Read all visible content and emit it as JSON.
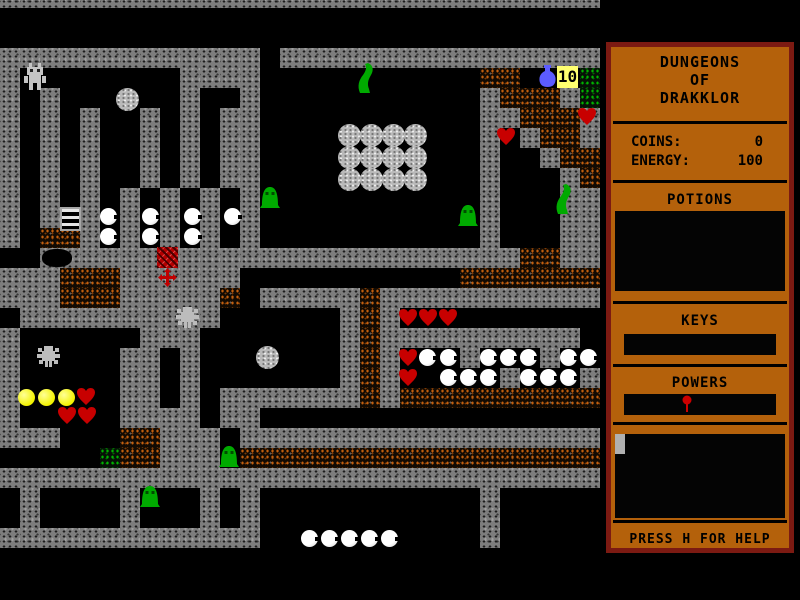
{
  "window": {
    "width": 800,
    "height": 600,
    "background": "#000000"
  },
  "colors": {
    "panel_bg": "#b4610b",
    "panel_border": "#7c1a12",
    "panel_text": "#000000",
    "wall_gray": "#7d7d7d",
    "dirt_orange": "#c3600f",
    "moss_green": "#00b400",
    "heart_red": "#c80000",
    "slime_green": "#00aa00",
    "pearl_white": "#ffffff",
    "flask_blue": "#5c5cff",
    "key_label_bg": "#ffff70",
    "power_dot_red": "#cc0000"
  },
  "sidebar": {
    "title_lines": [
      "DUNGEONS",
      "OF",
      "DRAKKLOR"
    ],
    "stats": [
      {
        "label": "COINS:",
        "value": "0"
      },
      {
        "label": "ENERGY:",
        "value": "100"
      }
    ],
    "potions_label": "POTIONS",
    "keys_label": "KEYS",
    "powers_label": "POWERS",
    "powers_items": [
      "balloon-icon"
    ],
    "inventory_items": [
      "gray-chip"
    ],
    "help_text": "PRESS H FOR HELP"
  },
  "hud": {
    "key_count": "10"
  },
  "map": {
    "tile_size": 20,
    "offset_y": -12,
    "legend": {
      "#": "wall",
      "%": "dirt",
      "g": "moss",
      ".": "floor"
    },
    "rows": [
      "##############################",
      "..............................",
      "..............................",
      "#############.################",
      "#........####...........%%...g",
      "#.#......#..#...........#%%%#g",
      "#.#.#..#.#.##...........##%%%#",
      "#.#.#..#.#.##...........#.#%%#",
      "#.#.#..#.#.##...........#..#%%",
      "#.#.#..#.#.##...........#...#%",
      "#.#.#.#.#.#.#...........#...##",
      "#.#.#.#.#.#.#...........#...##",
      "#.%%#.#.#.#.#...........#...##",
      "..########################%%##",
      "###%%%######...........%%%%%%%",
      "###%%%#####%.#####%###########",
      ".##########......#%#..........",
      "#......###.......#%##########",
      "#.....##.#.......#%#...#...#..",
      "#.....##.#.......#%#.....#...#",
      "#.....##.#.#######%#%%%%%%%%%%",
      "#.....####.##.................",
      "###...%%###.##################",
      ".....g%%###.%%%%%%%%%%%%%%%%%%",
      "##############################",
      ".#....#...#.#...........#.....",
      ".#....#...#.#...........#.....",
      "#############...........#.....",
      ".............................."
    ],
    "sprites": [
      {
        "t": "robot",
        "x": 22,
        "y": 63
      },
      {
        "t": "boulder",
        "x": 116,
        "y": 88
      },
      {
        "t": "worm",
        "x": 355,
        "y": 62
      },
      {
        "t": "flask",
        "x": 538,
        "y": 65
      },
      {
        "t": "label10",
        "x": 557,
        "y": 66
      },
      {
        "t": "heart",
        "x": 577,
        "y": 107
      },
      {
        "t": "heart",
        "x": 496,
        "y": 127
      },
      {
        "t": "boulder",
        "x": 338,
        "y": 124
      },
      {
        "t": "boulder",
        "x": 360,
        "y": 124
      },
      {
        "t": "boulder",
        "x": 382,
        "y": 124
      },
      {
        "t": "boulder",
        "x": 404,
        "y": 124
      },
      {
        "t": "boulder",
        "x": 338,
        "y": 146
      },
      {
        "t": "boulder",
        "x": 360,
        "y": 146
      },
      {
        "t": "boulder",
        "x": 382,
        "y": 146
      },
      {
        "t": "boulder",
        "x": 404,
        "y": 146
      },
      {
        "t": "boulder",
        "x": 338,
        "y": 168
      },
      {
        "t": "boulder",
        "x": 360,
        "y": 168
      },
      {
        "t": "boulder",
        "x": 382,
        "y": 168
      },
      {
        "t": "boulder",
        "x": 404,
        "y": 168
      },
      {
        "t": "gumdrop",
        "x": 260,
        "y": 184
      },
      {
        "t": "gumdrop",
        "x": 458,
        "y": 202
      },
      {
        "t": "worm",
        "x": 553,
        "y": 183
      },
      {
        "t": "ladder",
        "x": 60,
        "y": 207
      },
      {
        "t": "pearl",
        "x": 100,
        "y": 208
      },
      {
        "t": "pearl",
        "x": 142,
        "y": 208
      },
      {
        "t": "pearl",
        "x": 184,
        "y": 208
      },
      {
        "t": "pearl",
        "x": 224,
        "y": 208
      },
      {
        "t": "pearl",
        "x": 100,
        "y": 228
      },
      {
        "t": "pearl",
        "x": 142,
        "y": 228
      },
      {
        "t": "pearl",
        "x": 184,
        "y": 228
      },
      {
        "t": "chest",
        "x": 157,
        "y": 247
      },
      {
        "t": "cross",
        "x": 157,
        "y": 267
      },
      {
        "t": "blob",
        "x": 42,
        "y": 249
      },
      {
        "t": "spider",
        "x": 175,
        "y": 305
      },
      {
        "t": "heart",
        "x": 398,
        "y": 308
      },
      {
        "t": "heart",
        "x": 418,
        "y": 308
      },
      {
        "t": "heart",
        "x": 438,
        "y": 308
      },
      {
        "t": "spider",
        "x": 36,
        "y": 344
      },
      {
        "t": "boulder",
        "x": 256,
        "y": 346
      },
      {
        "t": "heart",
        "x": 398,
        "y": 348
      },
      {
        "t": "pearl",
        "x": 419,
        "y": 349
      },
      {
        "t": "pearl",
        "x": 440,
        "y": 349
      },
      {
        "t": "pearl",
        "x": 480,
        "y": 349
      },
      {
        "t": "pearl",
        "x": 500,
        "y": 349
      },
      {
        "t": "pearl",
        "x": 520,
        "y": 349
      },
      {
        "t": "pearl",
        "x": 560,
        "y": 349
      },
      {
        "t": "pearl",
        "x": 580,
        "y": 349
      },
      {
        "t": "heart",
        "x": 398,
        "y": 368
      },
      {
        "t": "pearl",
        "x": 440,
        "y": 369
      },
      {
        "t": "pearl",
        "x": 460,
        "y": 369
      },
      {
        "t": "pearl",
        "x": 480,
        "y": 369
      },
      {
        "t": "pearl",
        "x": 520,
        "y": 369
      },
      {
        "t": "pearl",
        "x": 540,
        "y": 369
      },
      {
        "t": "pearl",
        "x": 560,
        "y": 369
      },
      {
        "t": "yellow",
        "x": 18,
        "y": 389
      },
      {
        "t": "yellow",
        "x": 38,
        "y": 389
      },
      {
        "t": "yellow",
        "x": 58,
        "y": 389
      },
      {
        "t": "heart",
        "x": 76,
        "y": 387
      },
      {
        "t": "heart",
        "x": 57,
        "y": 406
      },
      {
        "t": "heart",
        "x": 77,
        "y": 406
      },
      {
        "t": "gumdrop",
        "x": 219,
        "y": 443
      },
      {
        "t": "gumdrop",
        "x": 140,
        "y": 483
      },
      {
        "t": "pearl",
        "x": 301,
        "y": 530
      },
      {
        "t": "pearl",
        "x": 321,
        "y": 530
      },
      {
        "t": "pearl",
        "x": 341,
        "y": 530
      },
      {
        "t": "pearl",
        "x": 361,
        "y": 530
      },
      {
        "t": "pearl",
        "x": 381,
        "y": 530
      }
    ]
  }
}
